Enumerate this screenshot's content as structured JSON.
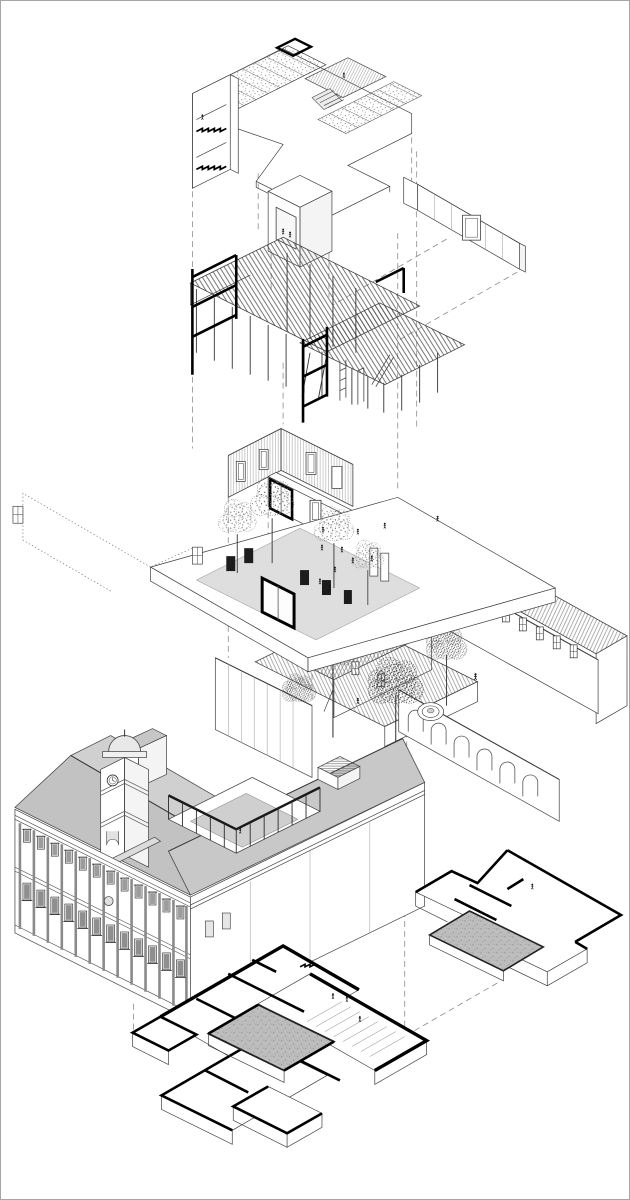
{
  "document": {
    "kind": "architectural exploded axonometric drawing",
    "background": "#ffffff",
    "frame_color": "#a6a6a6"
  },
  "palette": {
    "line": "#3f3f3f",
    "ink": "#000000",
    "projection_dash": "#8c8c8c",
    "roof_gray": "#c6c6c6",
    "roof_gray_light": "#d2d2d2",
    "paving_gray": "#dedede",
    "deck_gray": "#d6d6d6",
    "slab_gray": "#b8b8b8"
  },
  "layers": [
    {
      "id": "roof-terrace",
      "label": "Roof terrace with green roof strips, timber deck, skylight and stair core"
    },
    {
      "id": "elevator-core",
      "label": "Elevator core with two figures"
    },
    {
      "id": "structural-pergola",
      "label": "Timber joist structure on slender columns with black steel frames"
    },
    {
      "id": "upper-walls",
      "label": "Upper-level wall enclosure with window and door openings"
    },
    {
      "id": "plaza",
      "label": "Raised public plaza with trees, planters and people"
    },
    {
      "id": "existing-buildings",
      "label": "Existing courtyard buildings with tiled roofs, arcade wall, fountain and mature trees"
    },
    {
      "id": "historic-building",
      "label": "Historic corner building with clock tower and internal courtyard"
    },
    {
      "id": "basement-annex",
      "label": "Annex basement floor plan with sunken slab"
    },
    {
      "id": "basement-main",
      "label": "Main basement floor plan with sunken lightwell slab and stair"
    },
    {
      "id": "wall-fragment",
      "label": "Detached boundary wall fragment with window opening"
    },
    {
      "id": "projection-lines",
      "label": "Dashed projection lines linking the exploded layers"
    }
  ],
  "figures": {
    "people_count": 22,
    "plaza_trees": 4,
    "courtyard_trees": 4,
    "arcade_arches": 6,
    "facade_window_bays": 12
  }
}
